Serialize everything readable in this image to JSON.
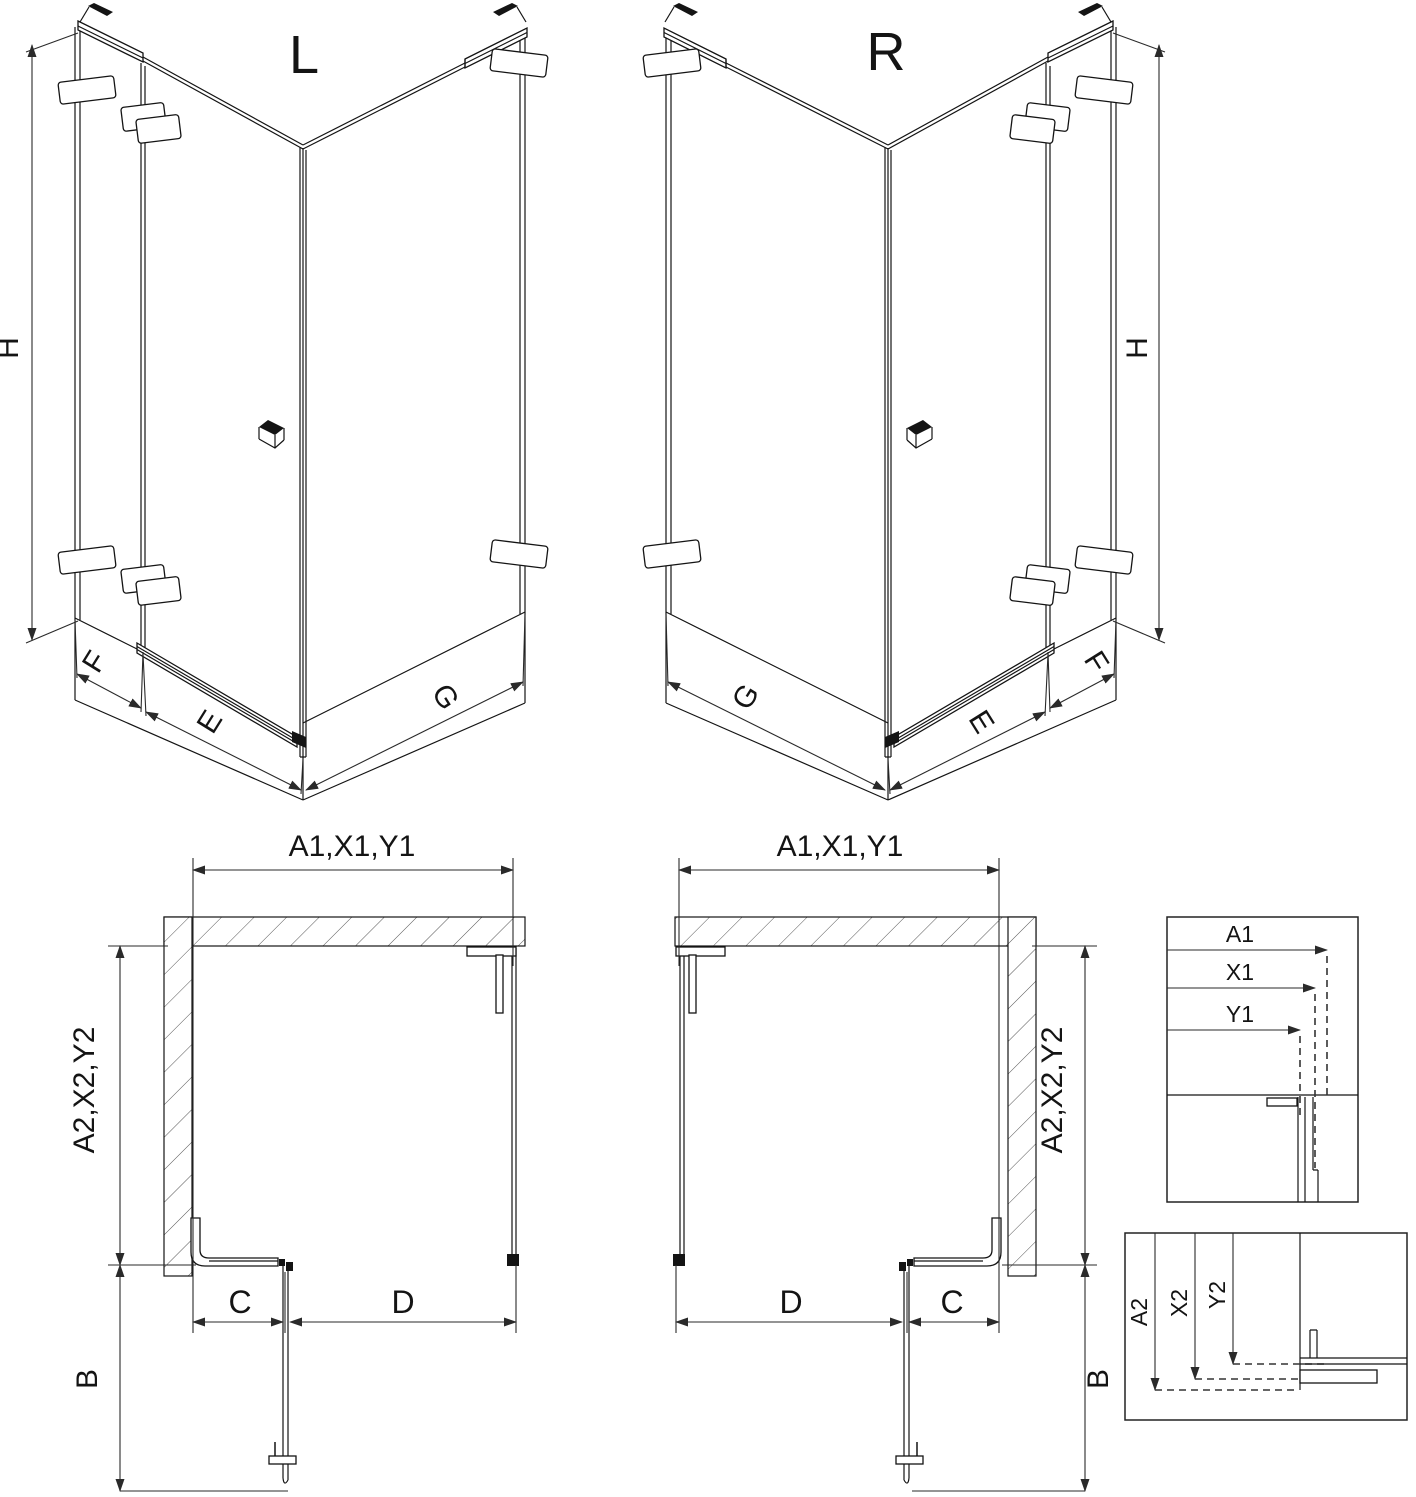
{
  "views": {
    "iso_left": {
      "label": "L",
      "dim_height": "H",
      "dim_side_panel": "F",
      "dim_door": "E",
      "dim_return_panel": "G"
    },
    "iso_right": {
      "label": "R",
      "dim_height": "H",
      "dim_side_panel": "F",
      "dim_door": "E",
      "dim_return_panel": "G"
    },
    "plan_left": {
      "dim_width": "A1,X1,Y1",
      "dim_depth": "A2,X2,Y2",
      "dim_side": "C",
      "dim_opening": "D",
      "dim_door_swing": "B"
    },
    "plan_right": {
      "dim_width": "A1,X1,Y1",
      "dim_depth": "A2,X2,Y2",
      "dim_side": "C",
      "dim_opening": "D",
      "dim_door_swing": "B"
    }
  },
  "details": {
    "width": {
      "labels": [
        "A1",
        "X1",
        "Y1"
      ]
    },
    "depth": {
      "labels": [
        "A2",
        "X2",
        "Y2"
      ]
    }
  },
  "colors": {
    "line": "#141414",
    "background": "#ffffff"
  }
}
